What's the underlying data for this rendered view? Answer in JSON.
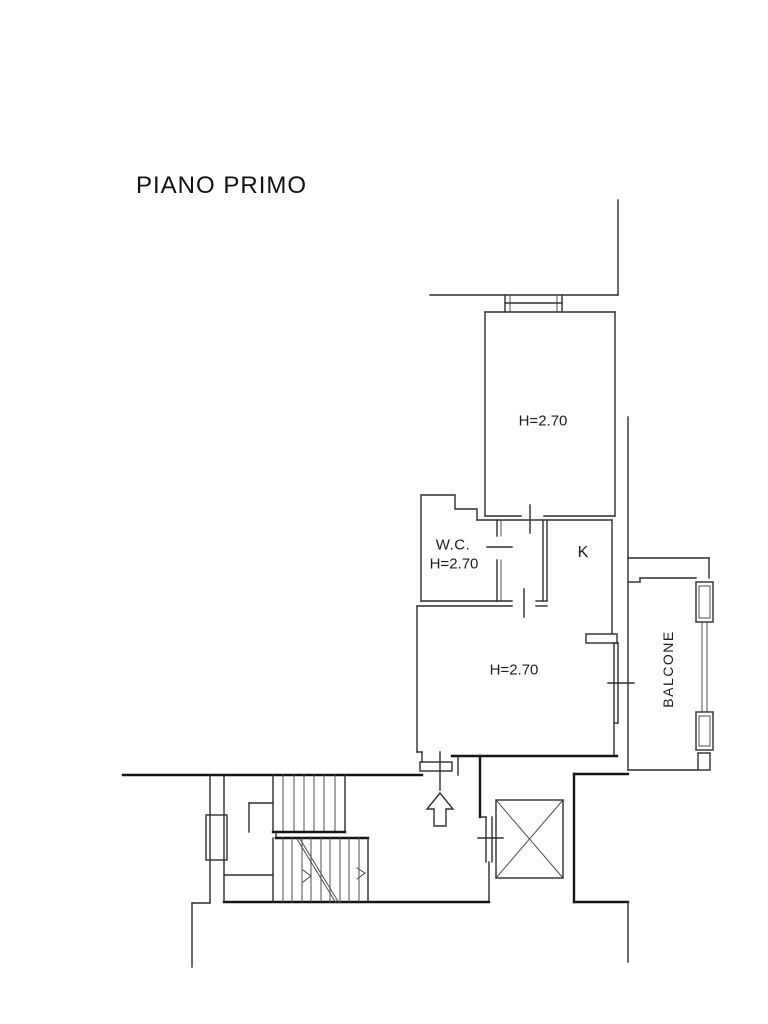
{
  "title": "PIANO PRIMO",
  "floor": {
    "name": "PIANO PRIMO",
    "rooms": [
      {
        "id": "bedroom",
        "height_note": "H=2.70"
      },
      {
        "id": "wc",
        "name": "W.C.",
        "height_note": "H=2.70"
      },
      {
        "id": "kitchen",
        "name": "K"
      },
      {
        "id": "living",
        "height_note": "H=2.70"
      },
      {
        "id": "balcony",
        "name": "BALCONE"
      }
    ]
  },
  "colors": {
    "background": "#ffffff",
    "wall_line": "#2e2e2e",
    "section_line": "#151515",
    "thin_line": "#4f4f4f",
    "text": "#1d1d1d"
  },
  "labels": [
    {
      "name": "label-bedroom-height",
      "text": "H=2.70",
      "x": 543,
      "y": 421,
      "size": 15,
      "rotate": 0,
      "spacing": 0
    },
    {
      "name": "label-wc-name",
      "text": "W.C.",
      "x": 453,
      "y": 545,
      "size": 15,
      "rotate": 0,
      "spacing": 0.5
    },
    {
      "name": "label-wc-height",
      "text": "H=2.70",
      "x": 454,
      "y": 564,
      "size": 15,
      "rotate": 0,
      "spacing": 0
    },
    {
      "name": "label-kitchen",
      "text": "K",
      "x": 583,
      "y": 553,
      "size": 16,
      "rotate": 0,
      "spacing": 0
    },
    {
      "name": "label-living-height",
      "text": "H=2.70",
      "x": 514,
      "y": 670,
      "size": 15,
      "rotate": 0,
      "spacing": 0
    },
    {
      "name": "label-balcony",
      "text": "BALCONE",
      "x": 668,
      "y": 669,
      "size": 14,
      "rotate": -90,
      "spacing": 1.5
    }
  ],
  "plan": {
    "segments": [
      [
        618,
        200,
        618,
        295,
        "w"
      ],
      [
        430,
        295,
        618,
        295,
        "w"
      ],
      [
        505,
        295,
        505,
        312,
        "w"
      ],
      [
        510,
        295,
        510,
        312,
        "n"
      ],
      [
        557,
        295,
        557,
        312,
        "n"
      ],
      [
        562,
        295,
        562,
        312,
        "w"
      ],
      [
        505,
        303,
        562,
        303,
        "w"
      ],
      [
        485,
        312,
        615,
        312,
        "w"
      ],
      [
        485,
        312,
        485,
        516,
        "w"
      ],
      [
        615,
        312,
        615,
        516,
        "w"
      ],
      [
        485,
        516,
        521,
        516,
        "w"
      ],
      [
        544,
        516,
        615,
        516,
        "w"
      ],
      [
        530,
        505,
        530,
        533,
        "w"
      ],
      [
        628,
        417,
        628,
        770,
        "w"
      ],
      [
        628,
        558,
        709,
        558,
        "w"
      ],
      [
        709,
        558,
        709,
        578,
        "w"
      ],
      [
        421,
        601,
        497,
        601,
        "w"
      ],
      [
        477,
        520,
        612,
        520,
        "w"
      ],
      [
        497,
        520,
        497,
        536,
        "w"
      ],
      [
        501,
        520,
        501,
        536,
        "n"
      ],
      [
        497,
        560,
        497,
        601,
        "w"
      ],
      [
        501,
        560,
        501,
        601,
        "n"
      ],
      [
        487,
        547,
        512,
        547,
        "w"
      ],
      [
        543,
        520,
        543,
        601,
        "w"
      ],
      [
        547,
        520,
        547,
        601,
        "w"
      ],
      [
        497,
        601,
        512,
        601,
        "w"
      ],
      [
        536,
        601,
        547,
        601,
        "w"
      ],
      [
        524,
        589,
        524,
        617,
        "w"
      ],
      [
        417,
        606,
        512,
        606,
        "w"
      ],
      [
        536,
        606,
        547,
        606,
        "w"
      ],
      [
        612,
        520,
        612,
        634,
        "w"
      ],
      [
        417,
        606,
        417,
        752,
        "w"
      ],
      [
        417,
        752,
        422,
        752,
        "w"
      ],
      [
        422,
        752,
        422,
        762,
        "w"
      ],
      [
        452,
        756,
        617,
        756,
        "k"
      ],
      [
        614,
        643,
        614,
        755,
        "w"
      ],
      [
        618,
        643,
        618,
        723,
        "w"
      ],
      [
        614,
        643,
        618,
        643,
        "w"
      ],
      [
        614,
        723,
        618,
        723,
        "w"
      ],
      [
        608,
        683,
        634,
        683,
        "w"
      ],
      [
        440,
        752,
        440,
        790,
        "w"
      ],
      [
        458,
        756,
        458,
        775,
        "w"
      ],
      [
        123,
        775,
        422,
        775,
        "k"
      ],
      [
        480,
        756,
        480,
        817,
        "k"
      ],
      [
        480,
        817,
        486,
        817,
        "w"
      ],
      [
        486,
        817,
        486,
        862,
        "w"
      ],
      [
        492,
        817,
        492,
        862,
        "w"
      ],
      [
        478,
        838,
        503,
        838,
        "w"
      ],
      [
        489,
        862,
        489,
        902,
        "w"
      ],
      [
        224,
        902,
        489,
        902,
        "k"
      ],
      [
        192,
        903,
        210,
        903,
        "w"
      ],
      [
        192,
        903,
        192,
        967,
        "w"
      ],
      [
        210,
        775,
        210,
        903,
        "w"
      ],
      [
        224,
        775,
        224,
        902,
        "w"
      ],
      [
        273,
        775,
        273,
        832,
        "w"
      ],
      [
        283,
        775,
        283,
        832,
        "n"
      ],
      [
        294,
        775,
        294,
        832,
        "n"
      ],
      [
        304,
        775,
        304,
        832,
        "n"
      ],
      [
        314,
        775,
        314,
        832,
        "n"
      ],
      [
        324,
        775,
        324,
        832,
        "n"
      ],
      [
        335,
        775,
        335,
        832,
        "n"
      ],
      [
        345,
        775,
        345,
        832,
        "w"
      ],
      [
        273,
        832,
        345,
        832,
        "k"
      ],
      [
        276,
        832,
        276,
        838,
        "w"
      ],
      [
        276,
        838,
        368,
        838,
        "k"
      ],
      [
        273,
        838,
        273,
        902,
        "w"
      ],
      [
        283,
        838,
        283,
        902,
        "n"
      ],
      [
        292,
        838,
        292,
        902,
        "n"
      ],
      [
        302,
        838,
        302,
        902,
        "n"
      ],
      [
        311,
        838,
        311,
        902,
        "n"
      ],
      [
        321,
        838,
        321,
        902,
        "n"
      ],
      [
        330,
        838,
        330,
        902,
        "n"
      ],
      [
        340,
        838,
        340,
        902,
        "n"
      ],
      [
        349,
        838,
        349,
        902,
        "n"
      ],
      [
        359,
        838,
        359,
        902,
        "n"
      ],
      [
        368,
        838,
        368,
        902,
        "w"
      ],
      [
        249,
        803,
        273,
        803,
        "w"
      ],
      [
        249,
        803,
        249,
        832,
        "w"
      ],
      [
        224,
        875,
        273,
        875,
        "w"
      ],
      [
        297,
        839,
        336,
        903,
        "n"
      ],
      [
        300,
        839,
        339,
        903,
        "n"
      ],
      [
        303,
        870,
        311,
        876,
        "n"
      ],
      [
        303,
        882,
        311,
        876,
        "n"
      ],
      [
        357,
        868,
        365,
        873,
        "n"
      ],
      [
        357,
        879,
        365,
        873,
        "n"
      ],
      [
        574,
        774,
        628,
        774,
        "k"
      ],
      [
        574,
        774,
        574,
        902,
        "k"
      ],
      [
        574,
        902,
        628,
        902,
        "k"
      ],
      [
        628,
        902,
        628,
        962,
        "w"
      ],
      [
        628,
        582,
        640,
        582,
        "w"
      ],
      [
        640,
        578,
        640,
        582,
        "w"
      ],
      [
        640,
        578,
        696,
        578,
        "w"
      ],
      [
        628,
        770,
        698,
        770,
        "w"
      ],
      [
        702,
        622,
        702,
        712,
        "n"
      ],
      [
        707,
        622,
        707,
        712,
        "n"
      ],
      [
        496,
        800,
        563,
        878,
        "n"
      ],
      [
        496,
        878,
        563,
        800,
        "n"
      ]
    ],
    "rects": [
      [
        586,
        634,
        31,
        9,
        "w"
      ],
      [
        420,
        762,
        32,
        9,
        "w"
      ],
      [
        206,
        815,
        21,
        45,
        "w"
      ],
      [
        696,
        582,
        17,
        40,
        "w"
      ],
      [
        699,
        586,
        11,
        32,
        "n"
      ],
      [
        696,
        712,
        17,
        38,
        "w"
      ],
      [
        699,
        716,
        11,
        30,
        "n"
      ],
      [
        698,
        753,
        12,
        17,
        "w"
      ],
      [
        496,
        800,
        67,
        78,
        "w"
      ]
    ],
    "polylines": [
      {
        "points": "421,601 421,495 455,495 455,509 477,509 477,520",
        "cls": "w"
      }
    ],
    "polygons": [
      {
        "points": "440,793 427,809 434,809 434,826 446,826 446,809 453,809",
        "cls": "w",
        "fill": "#ffffff",
        "name": "stairs-up-arrow-icon"
      }
    ]
  }
}
